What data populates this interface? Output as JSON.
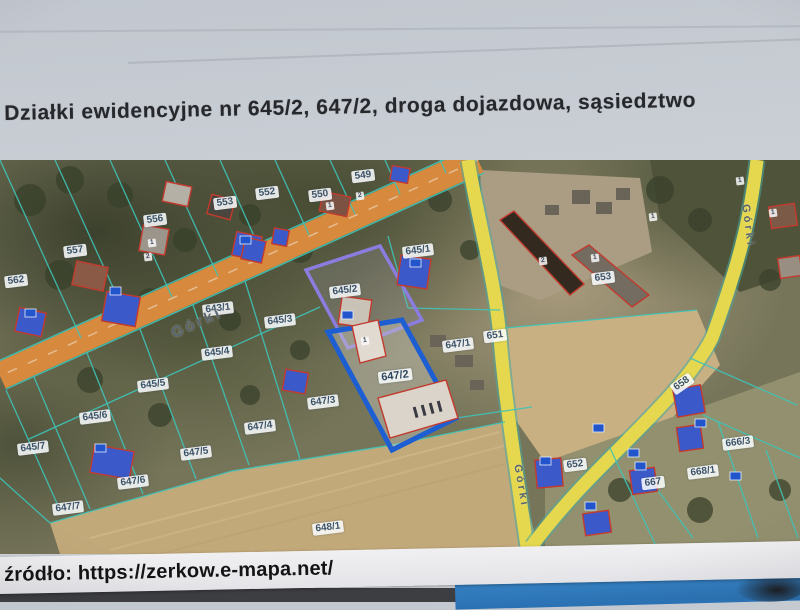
{
  "page": {
    "title": "Działki ewidencyjne nr 645/2, 647/2, droga dojazdowa, sąsiedztwo",
    "source_label": "źródło: https://zerkow.e-mapa.net/"
  },
  "map": {
    "highlighted_parcels": [
      "645/2",
      "647/2"
    ],
    "colors": {
      "access_road_orange": "#d7893e",
      "public_road_yellow": "#e6d84e",
      "parcel_boundary_teal": "#3fc4b8",
      "selection_blue": "#1d5fd2",
      "selection_purple": "#8b7ce0",
      "building_blue": "#3c59c9",
      "building_outline_red": "#c23b2e",
      "label_text": "#3b5268"
    },
    "street_labels": [
      {
        "text": "Górki",
        "x": 197,
        "y": 163,
        "rot": -24,
        "size": 15
      },
      {
        "text": "Górki",
        "x": 748,
        "y": 66,
        "rot": 83,
        "size": 11
      },
      {
        "text": "Górki",
        "x": 521,
        "y": 326,
        "rot": 80,
        "size": 11
      }
    ],
    "parcel_labels": [
      {
        "text": "549",
        "x": 363,
        "y": 16
      },
      {
        "text": "550",
        "x": 320,
        "y": 35
      },
      {
        "text": "552",
        "x": 267,
        "y": 33
      },
      {
        "text": "553",
        "x": 225,
        "y": 43
      },
      {
        "text": "556",
        "x": 155,
        "y": 60
      },
      {
        "text": "557",
        "x": 75,
        "y": 91
      },
      {
        "text": "562",
        "x": 16,
        "y": 121
      },
      {
        "text": "643/1",
        "x": 218,
        "y": 149
      },
      {
        "text": "645/1",
        "x": 418,
        "y": 91
      },
      {
        "text": "645/2",
        "x": 345,
        "y": 131
      },
      {
        "text": "645/3",
        "x": 280,
        "y": 161
      },
      {
        "text": "645/4",
        "x": 217,
        "y": 193
      },
      {
        "text": "645/5",
        "x": 153,
        "y": 225
      },
      {
        "text": "645/6",
        "x": 95,
        "y": 257
      },
      {
        "text": "645/7",
        "x": 33,
        "y": 288
      },
      {
        "text": "647/1",
        "x": 458,
        "y": 185
      },
      {
        "text": "647/2",
        "x": 395,
        "y": 216,
        "bold": true
      },
      {
        "text": "647/3",
        "x": 323,
        "y": 242
      },
      {
        "text": "647/4",
        "x": 260,
        "y": 267
      },
      {
        "text": "647/5",
        "x": 196,
        "y": 293
      },
      {
        "text": "647/6",
        "x": 133,
        "y": 322
      },
      {
        "text": "647/7",
        "x": 68,
        "y": 348
      },
      {
        "text": "648/1",
        "x": 328,
        "y": 368
      },
      {
        "text": "651",
        "x": 495,
        "y": 176
      },
      {
        "text": "653",
        "x": 603,
        "y": 118
      },
      {
        "text": "652",
        "x": 575,
        "y": 305
      },
      {
        "text": "658",
        "x": 682,
        "y": 224,
        "rot": -35
      },
      {
        "text": "666/3",
        "x": 738,
        "y": 283
      },
      {
        "text": "667",
        "x": 653,
        "y": 323
      },
      {
        "text": "668/1",
        "x": 703,
        "y": 312
      }
    ],
    "building_badges": [
      {
        "text": "1",
        "x": 152,
        "y": 83
      },
      {
        "text": "2",
        "x": 148,
        "y": 97
      },
      {
        "text": "2",
        "x": 360,
        "y": 36
      },
      {
        "text": "1",
        "x": 330,
        "y": 46
      },
      {
        "text": "2",
        "x": 543,
        "y": 101
      },
      {
        "text": "1",
        "x": 595,
        "y": 98
      },
      {
        "text": "1",
        "x": 653,
        "y": 57
      },
      {
        "text": "1",
        "x": 740,
        "y": 21
      },
      {
        "text": "1",
        "x": 773,
        "y": 53
      },
      {
        "text": "1",
        "x": 365,
        "y": 181
      }
    ]
  }
}
